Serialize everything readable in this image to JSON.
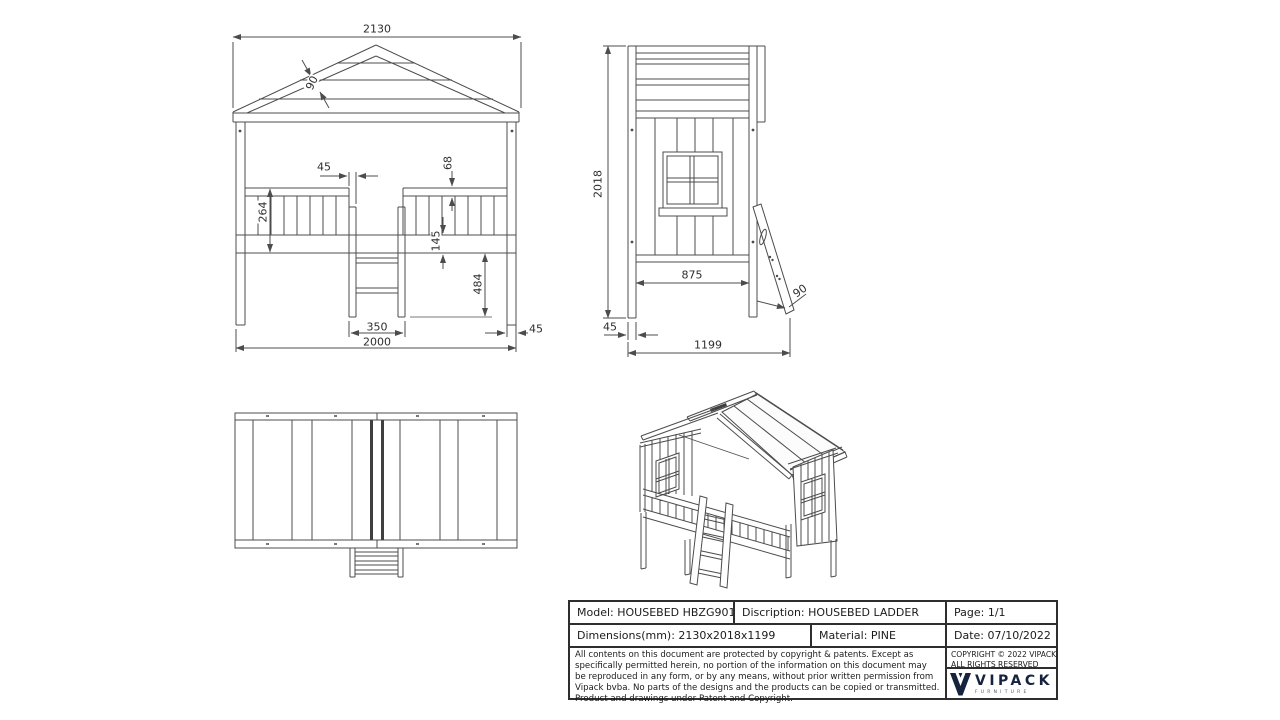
{
  "front_view": {
    "dims": {
      "overall_width": "2130",
      "roof_board": "90",
      "rail_gap": "45",
      "rail_offset": "68",
      "rail_height": "264",
      "frame_height": "145",
      "under_clearance": "484",
      "ladder_width": "350",
      "bed_length": "2000",
      "post_width": "45"
    }
  },
  "side_view": {
    "dims": {
      "overall_height": "2018",
      "inner_depth": "875",
      "ladder_board": "90",
      "post_width": "45",
      "overall_depth": "1199"
    }
  },
  "title_block": {
    "model": "Model: HOUSEBED HBZG9014",
    "description": "Discription: HOUSEBED LADDER",
    "page": "Page: 1/1",
    "dimensions": "Dimensions(mm): 2130x2018x1199",
    "material": "Material: PINE",
    "date": "Date: 07/10/2022",
    "legal": "All contents on this document are protected by copyright & patents. Except as specifically permitted herein, no portion of the information on this document may be reproduced in any form, or by any means, without prior written permission from Vipack bvba. No parts of the designs and the products can be copied or transmitted. Product and drawings under Patent and Copyright.",
    "copyright_line1": "COPYRIGHT © 2022 VIPACK,",
    "copyright_line2": "ALL RIGHTS RESERVED",
    "brand": {
      "name": "VIPACK",
      "tagline": "FURNITURE"
    }
  },
  "colors": {
    "line": "#4c4c4c",
    "brand_navy": "#16233f"
  }
}
